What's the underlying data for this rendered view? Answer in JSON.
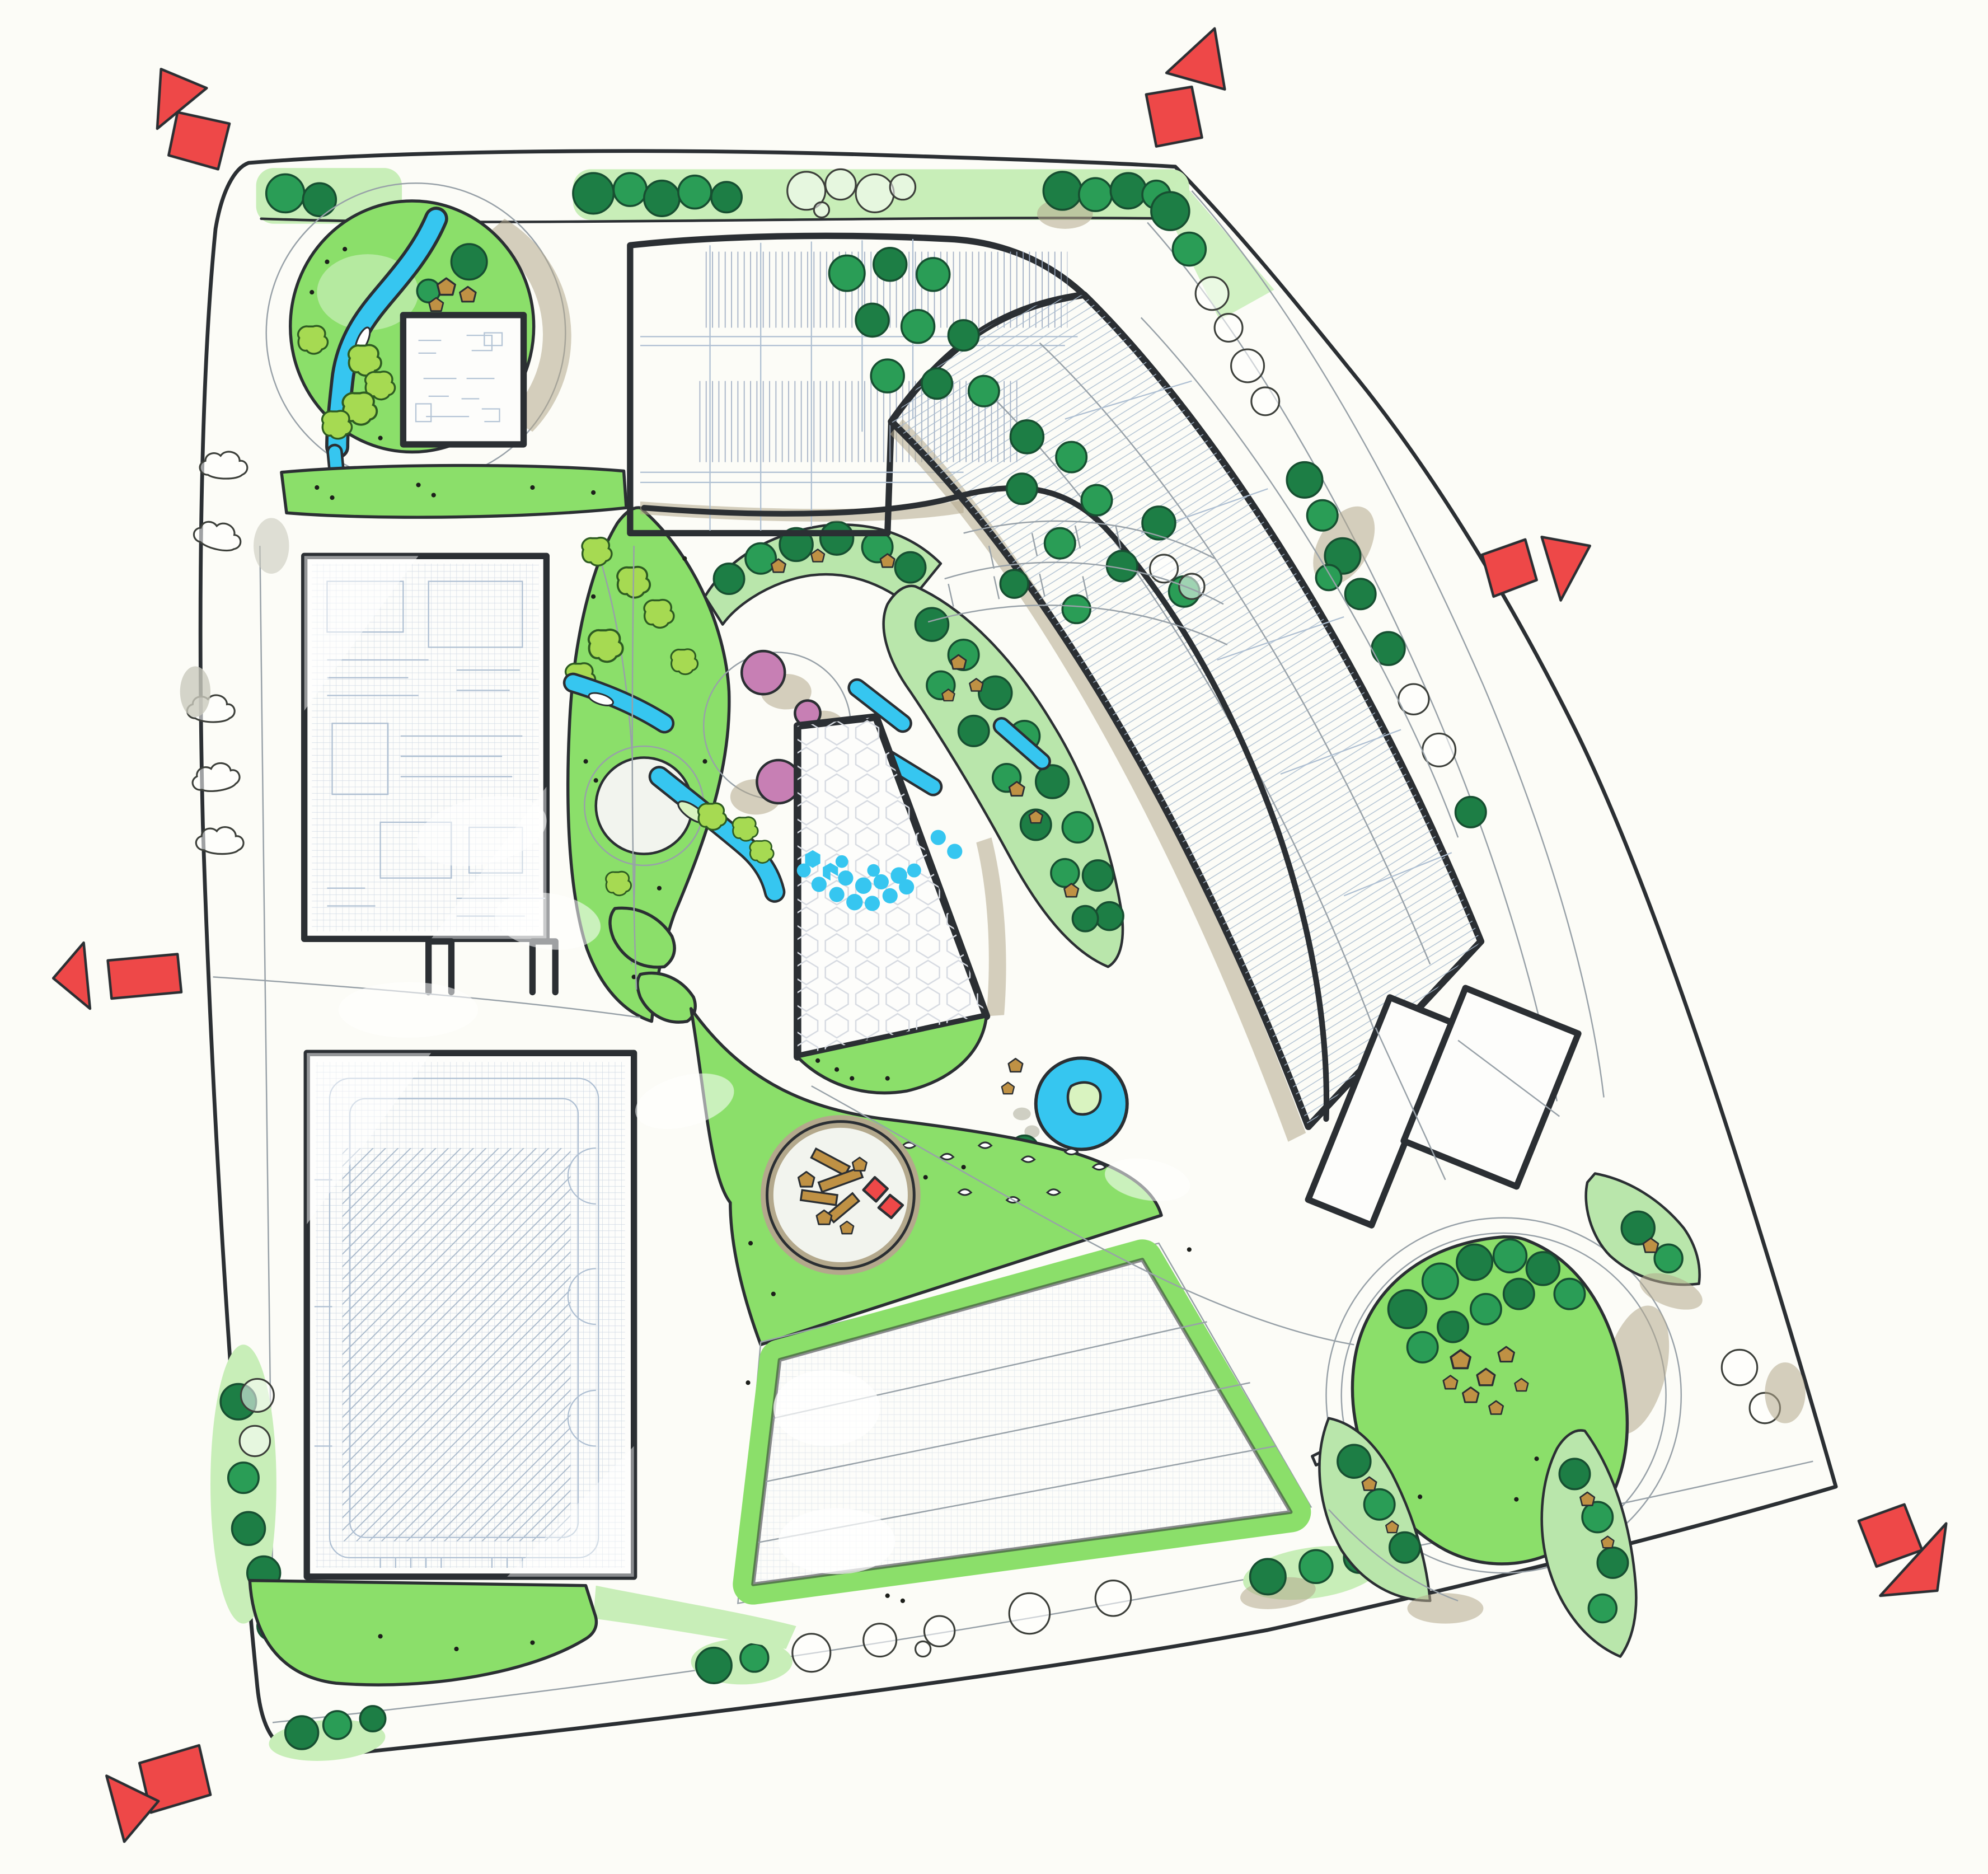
{
  "drawing": {
    "medium": "marker-and-pencil site plan",
    "entrance_marker_count": 6,
    "blossom_circle_count": 3,
    "pond_count": 1
  },
  "palette": {
    "paper": "#fcfcf7",
    "site": "#f2f4ee",
    "ink": "#2b2f33",
    "lawn": "#8bdf6a",
    "lawnWash": "#c8eeb8",
    "lawnPale": "#b9e6ab",
    "canopy": "#2a9d56",
    "canopyDark": "#1d7e45",
    "canopyStroke": "#174f31",
    "shrub": "#a6da52",
    "water": "#36c6f0",
    "pink": "#c77fb4",
    "rock": "#bf9144",
    "tan": "#b3a88c",
    "pencil": "#98a1a8",
    "pencilBlue": "#aebfd2",
    "red": "#ee4848"
  }
}
